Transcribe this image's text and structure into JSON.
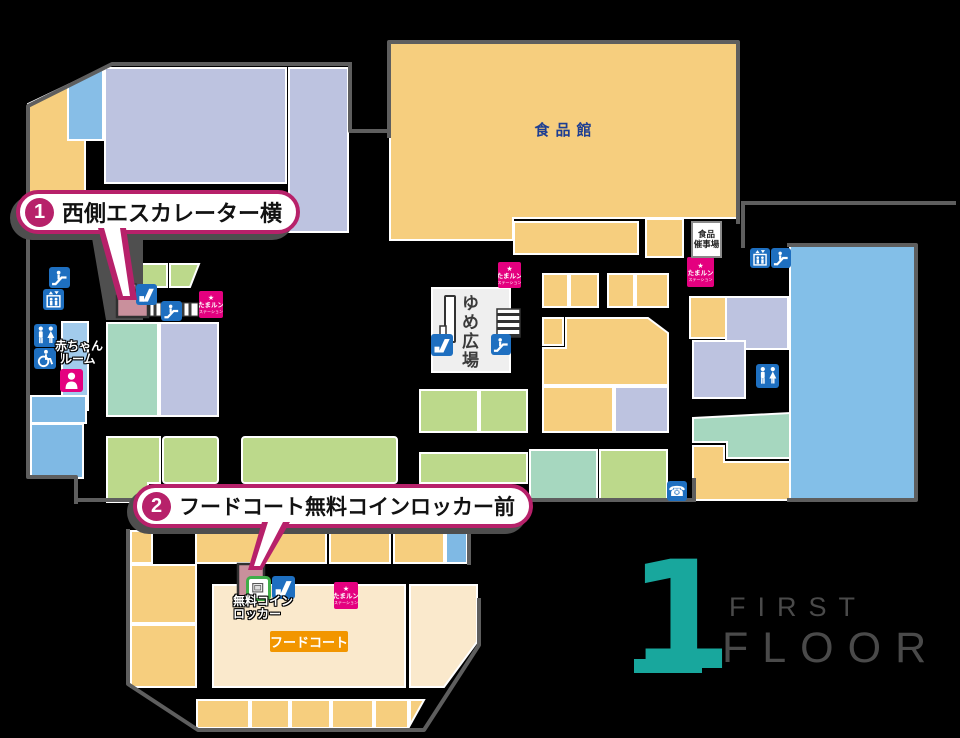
{
  "callouts": [
    {
      "number": "1",
      "label": "西側エスカレーター横"
    },
    {
      "number": "2",
      "label": "フードコート無料コインロッカー前"
    }
  ],
  "areas": {
    "food_hall": "食品館",
    "food_event": {
      "line1": "食品",
      "line2": "催事場"
    },
    "yume_plaza": "ゆめ広場",
    "food_court_label": "フードコート"
  },
  "labels": {
    "baby_room": {
      "line1": "赤ちゃん",
      "line2": "ルーム"
    },
    "free_locker": {
      "line1": "無料コイン",
      "line2": "ロッカー"
    }
  },
  "station": {
    "mascot": "★",
    "line1": "たまルン",
    "line2": "ステーション"
  },
  "icons": {
    "phone_glyph": "☎"
  },
  "floor": {
    "numeral": "1",
    "word_top": "FIRST",
    "word_bottom": "FLOOR"
  },
  "colors": {
    "callout_magenta": "#B7216A",
    "icon_blue": "#1E6FC0",
    "station_pink": "#E4007F",
    "floor_teal": "#18A79D",
    "block_yellow": "#F6CE7E",
    "block_cream": "#FAE9CC",
    "block_lavender": "#BDC3E0",
    "block_green": "#BCD98B",
    "block_mint": "#A6D7BF",
    "block_blue": "#83BFE8",
    "wall_gray": "#5E5E5E",
    "highlight_pink": "#C9909C",
    "foodcourt_orange": "#F29600",
    "food_hall_text_navy": "#1D3E92"
  }
}
